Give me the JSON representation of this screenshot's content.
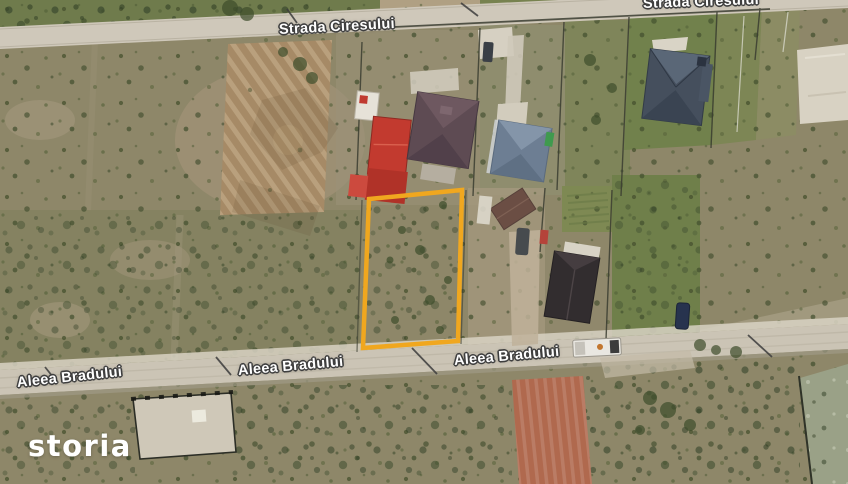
{
  "streets": {
    "top_left": "Strada Ciresului",
    "top_right": "Strada Ciresului",
    "bottom_left": "Aleea Bradului",
    "bottom_center": "Aleea Bradului",
    "bottom_right": "Aleea Bradului"
  },
  "branding": {
    "logo_text": "storia"
  },
  "highlight": {
    "plot_outline_color": "#F0A71F"
  }
}
